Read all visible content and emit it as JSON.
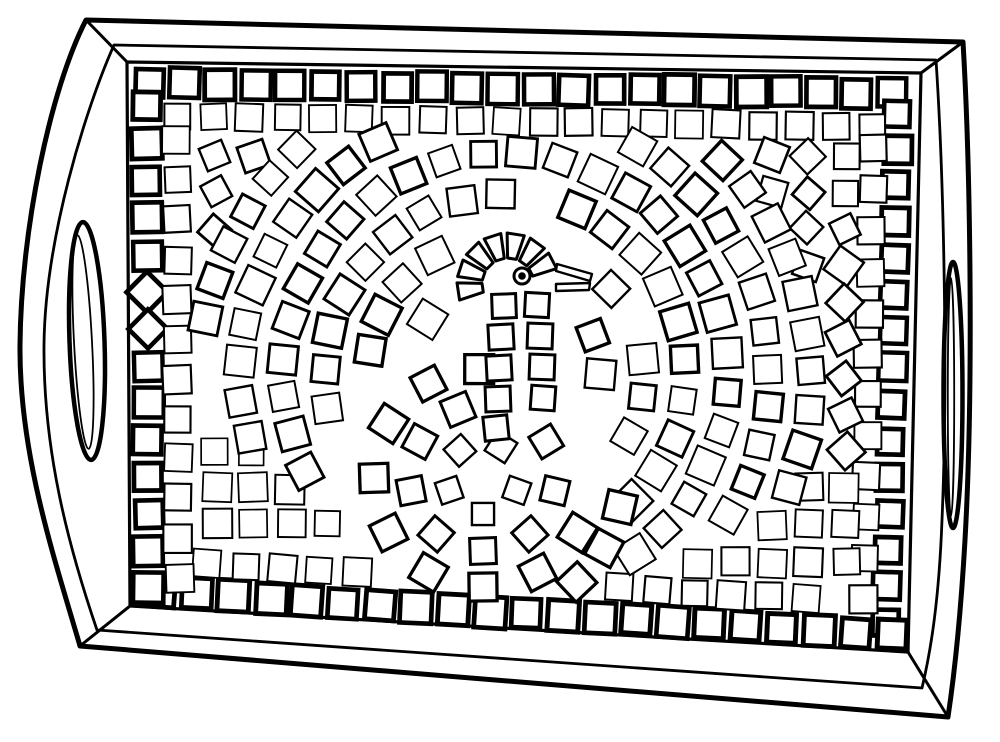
{
  "canvas": {
    "width": 1000,
    "height": 742,
    "background": "#ffffff",
    "line_color": "#000000"
  },
  "tray": {
    "outer_path": "M 86 20 L 963 42 C 970 160 974 380 965 540 C 961 610 955 670 948 717 L 80 646 C 55 560 19 455 20 345 C 21 230 50 90 86 20 Z",
    "mid_path": "M 114 45 L 936 60 C 944 180 948 380 942 520 C 939 600 931 650 922 688 L 97 630 C 68 545 43 450 44 345 C 45 240 85 110 114 45 Z",
    "field_quad": [
      [
        127,
        62
      ],
      [
        921,
        73
      ],
      [
        908,
        652
      ],
      [
        130,
        606
      ]
    ],
    "corner_lines": [
      [
        86,
        20,
        127,
        62
      ],
      [
        963,
        42,
        921,
        73
      ],
      [
        948,
        717,
        908,
        652
      ],
      [
        80,
        646,
        130,
        606
      ]
    ],
    "left_handle": {
      "cx": 87,
      "cy": 341,
      "rx": 17.5,
      "ry": 119,
      "tilt": -2,
      "inner": {
        "cx": 83,
        "cy": 342,
        "rx": 9,
        "ry": 107,
        "tilt": -3
      }
    },
    "right_handle": {
      "cx": 953,
      "cy": 395,
      "rx": 9.5,
      "ry": 133,
      "tilt": 0,
      "inner": {
        "cx": 951,
        "cy": 397,
        "rx": 3.2,
        "ry": 119,
        "tilt": 0
      }
    },
    "strokes": {
      "outer": 5,
      "mid": 2.8,
      "field": 3.2,
      "corner": 3,
      "handle_outer": 4.5,
      "handle_inner": 1.8
    }
  },
  "mosaic": {
    "seed": 20240613,
    "sides": {
      "top": {
        "a": [
          127,
          62
        ],
        "b": [
          921,
          73
        ],
        "normal": [
          0,
          1
        ]
      },
      "right": {
        "a": [
          921,
          73
        ],
        "b": [
          908,
          652
        ],
        "normal": [
          -1,
          0
        ]
      },
      "bottom": {
        "a": [
          130,
          606
        ],
        "b": [
          908,
          652
        ],
        "normal": [
          0.059,
          -0.998
        ]
      },
      "left": {
        "a": [
          127,
          62
        ],
        "b": [
          130,
          606
        ],
        "normal": [
          1,
          0
        ]
      }
    },
    "border_ring": {
      "top": {
        "t0": 22,
        "n": 22,
        "pitch": 35.4,
        "offset": 21,
        "size": 29,
        "sw": 4.6
      },
      "right": {
        "t0": 40,
        "n": 15,
        "pitch": 36.4,
        "offset": 22,
        "size": 27,
        "sw": 4.6
      },
      "bottom": {
        "t0": 30,
        "n": 21,
        "pitch": 36.6,
        "offset": 16,
        "size": 30,
        "sw": 4.8
      },
      "left": {
        "t0": 45,
        "n": 14,
        "pitch": 37,
        "offset": 19,
        "size": 29,
        "sw": 4.6,
        "diamonds": [
          5,
          6
        ]
      }
    },
    "second_ring": {
      "top": {
        "t0": 50,
        "n": 20,
        "pitch": 36.6,
        "offset": 54,
        "size": 27,
        "sw": 2
      },
      "left": {
        "t0": 78,
        "n": 12,
        "pitch": 39.8,
        "offset": 49,
        "size": 27,
        "sw": 2
      },
      "right": {
        "t0": 76,
        "n": 12,
        "pitch": 41,
        "offset": 46,
        "size": 27,
        "sw": 2
      },
      "bottom": {
        "t0": 75,
        "n": 17,
        "pitch": 37.5,
        "offset": 47,
        "size": 27,
        "sw": 2,
        "skip_x": [
          382,
          618
        ]
      }
    },
    "lattice": {
      "x0": 216,
      "y0": 155,
      "pitch": 37,
      "xmax": 845,
      "ymax": 594,
      "size": 27,
      "grid_sw": 1.9,
      "diamond_sw": 2.5,
      "grid_rmin": 385,
      "diamond_rmin": 318
    },
    "rings": {
      "cx": 505,
      "cy": 375,
      "radii": [
        96,
        138,
        180,
        222,
        264,
        306
      ],
      "arc_pitch": 39,
      "size": 28,
      "sw_choices": [
        2,
        2.4,
        2.9,
        3.4
      ],
      "skip": 0.04,
      "rot_jitter": 7
    },
    "clips": {
      "rings": [
        [
          199,
          134
        ],
        [
          849,
          145
        ],
        [
          838,
          576
        ],
        [
          202,
          530
        ]
      ],
      "general": [
        [
          171,
          104
        ],
        [
          879,
          115
        ],
        [
          866,
          594
        ],
        [
          174,
          548
        ]
      ]
    },
    "exclusions": {
      "circles": [
        [
          511,
          279,
          58
        ],
        [
          576,
          277,
          32
        ],
        [
          483,
          478,
          148
        ]
      ],
      "capsules": [
        [
          505,
          293,
          496,
          414,
          46
        ]
      ]
    },
    "corner_cut_lines": [
      [
        150,
        380,
        470,
        600
      ],
      [
        560,
        625,
        830,
        470
      ]
    ]
  },
  "bird": {
    "head_fan": {
      "cx": 508,
      "cy": 284,
      "r1": 26,
      "r2": 51,
      "a0": 158,
      "a1": 346,
      "n": 7,
      "sw": 3
    },
    "eye": {
      "cx": 522,
      "cy": 276,
      "r": 8,
      "pupil": 3.8,
      "sw": 3
    },
    "beak": {
      "sw": 2.4,
      "polys": [
        [
          557,
          264,
          592,
          274,
          590,
          281,
          556,
          271
        ],
        [
          556,
          284,
          590,
          283,
          589,
          290,
          556,
          291
        ]
      ]
    },
    "neck_tiles": [
      [
        504,
        306,
        24,
        -2
      ],
      [
        501,
        337,
        25,
        -3
      ],
      [
        499,
        368,
        25,
        -3
      ],
      [
        498,
        399,
        25,
        -2
      ],
      [
        496,
        428,
        24,
        -6
      ],
      [
        537,
        305,
        24,
        3
      ],
      [
        540,
        336,
        25,
        2
      ],
      [
        542,
        367,
        25,
        2
      ],
      [
        543,
        398,
        24,
        4
      ]
    ],
    "spiral": {
      "cx": 483,
      "cy": 478,
      "rings": [
        {
          "r": 36,
          "size": 23,
          "sw": 2.4,
          "angles": [
            20,
            90,
            160,
            230,
            300
          ]
        },
        {
          "r": 73,
          "size": 26,
          "sw": 3,
          "angles": [
            10,
            50,
            90,
            130,
            170,
            210,
            250,
            330
          ]
        },
        {
          "r": 109,
          "size": 28,
          "sw": 3.3,
          "angles": [
            30,
            60,
            90,
            120,
            150,
            180,
            210,
            240,
            268
          ]
        },
        {
          "r": 140,
          "size": 28,
          "sw": 3.3,
          "angles": [
            12,
            30,
            48
          ]
        }
      ]
    }
  }
}
